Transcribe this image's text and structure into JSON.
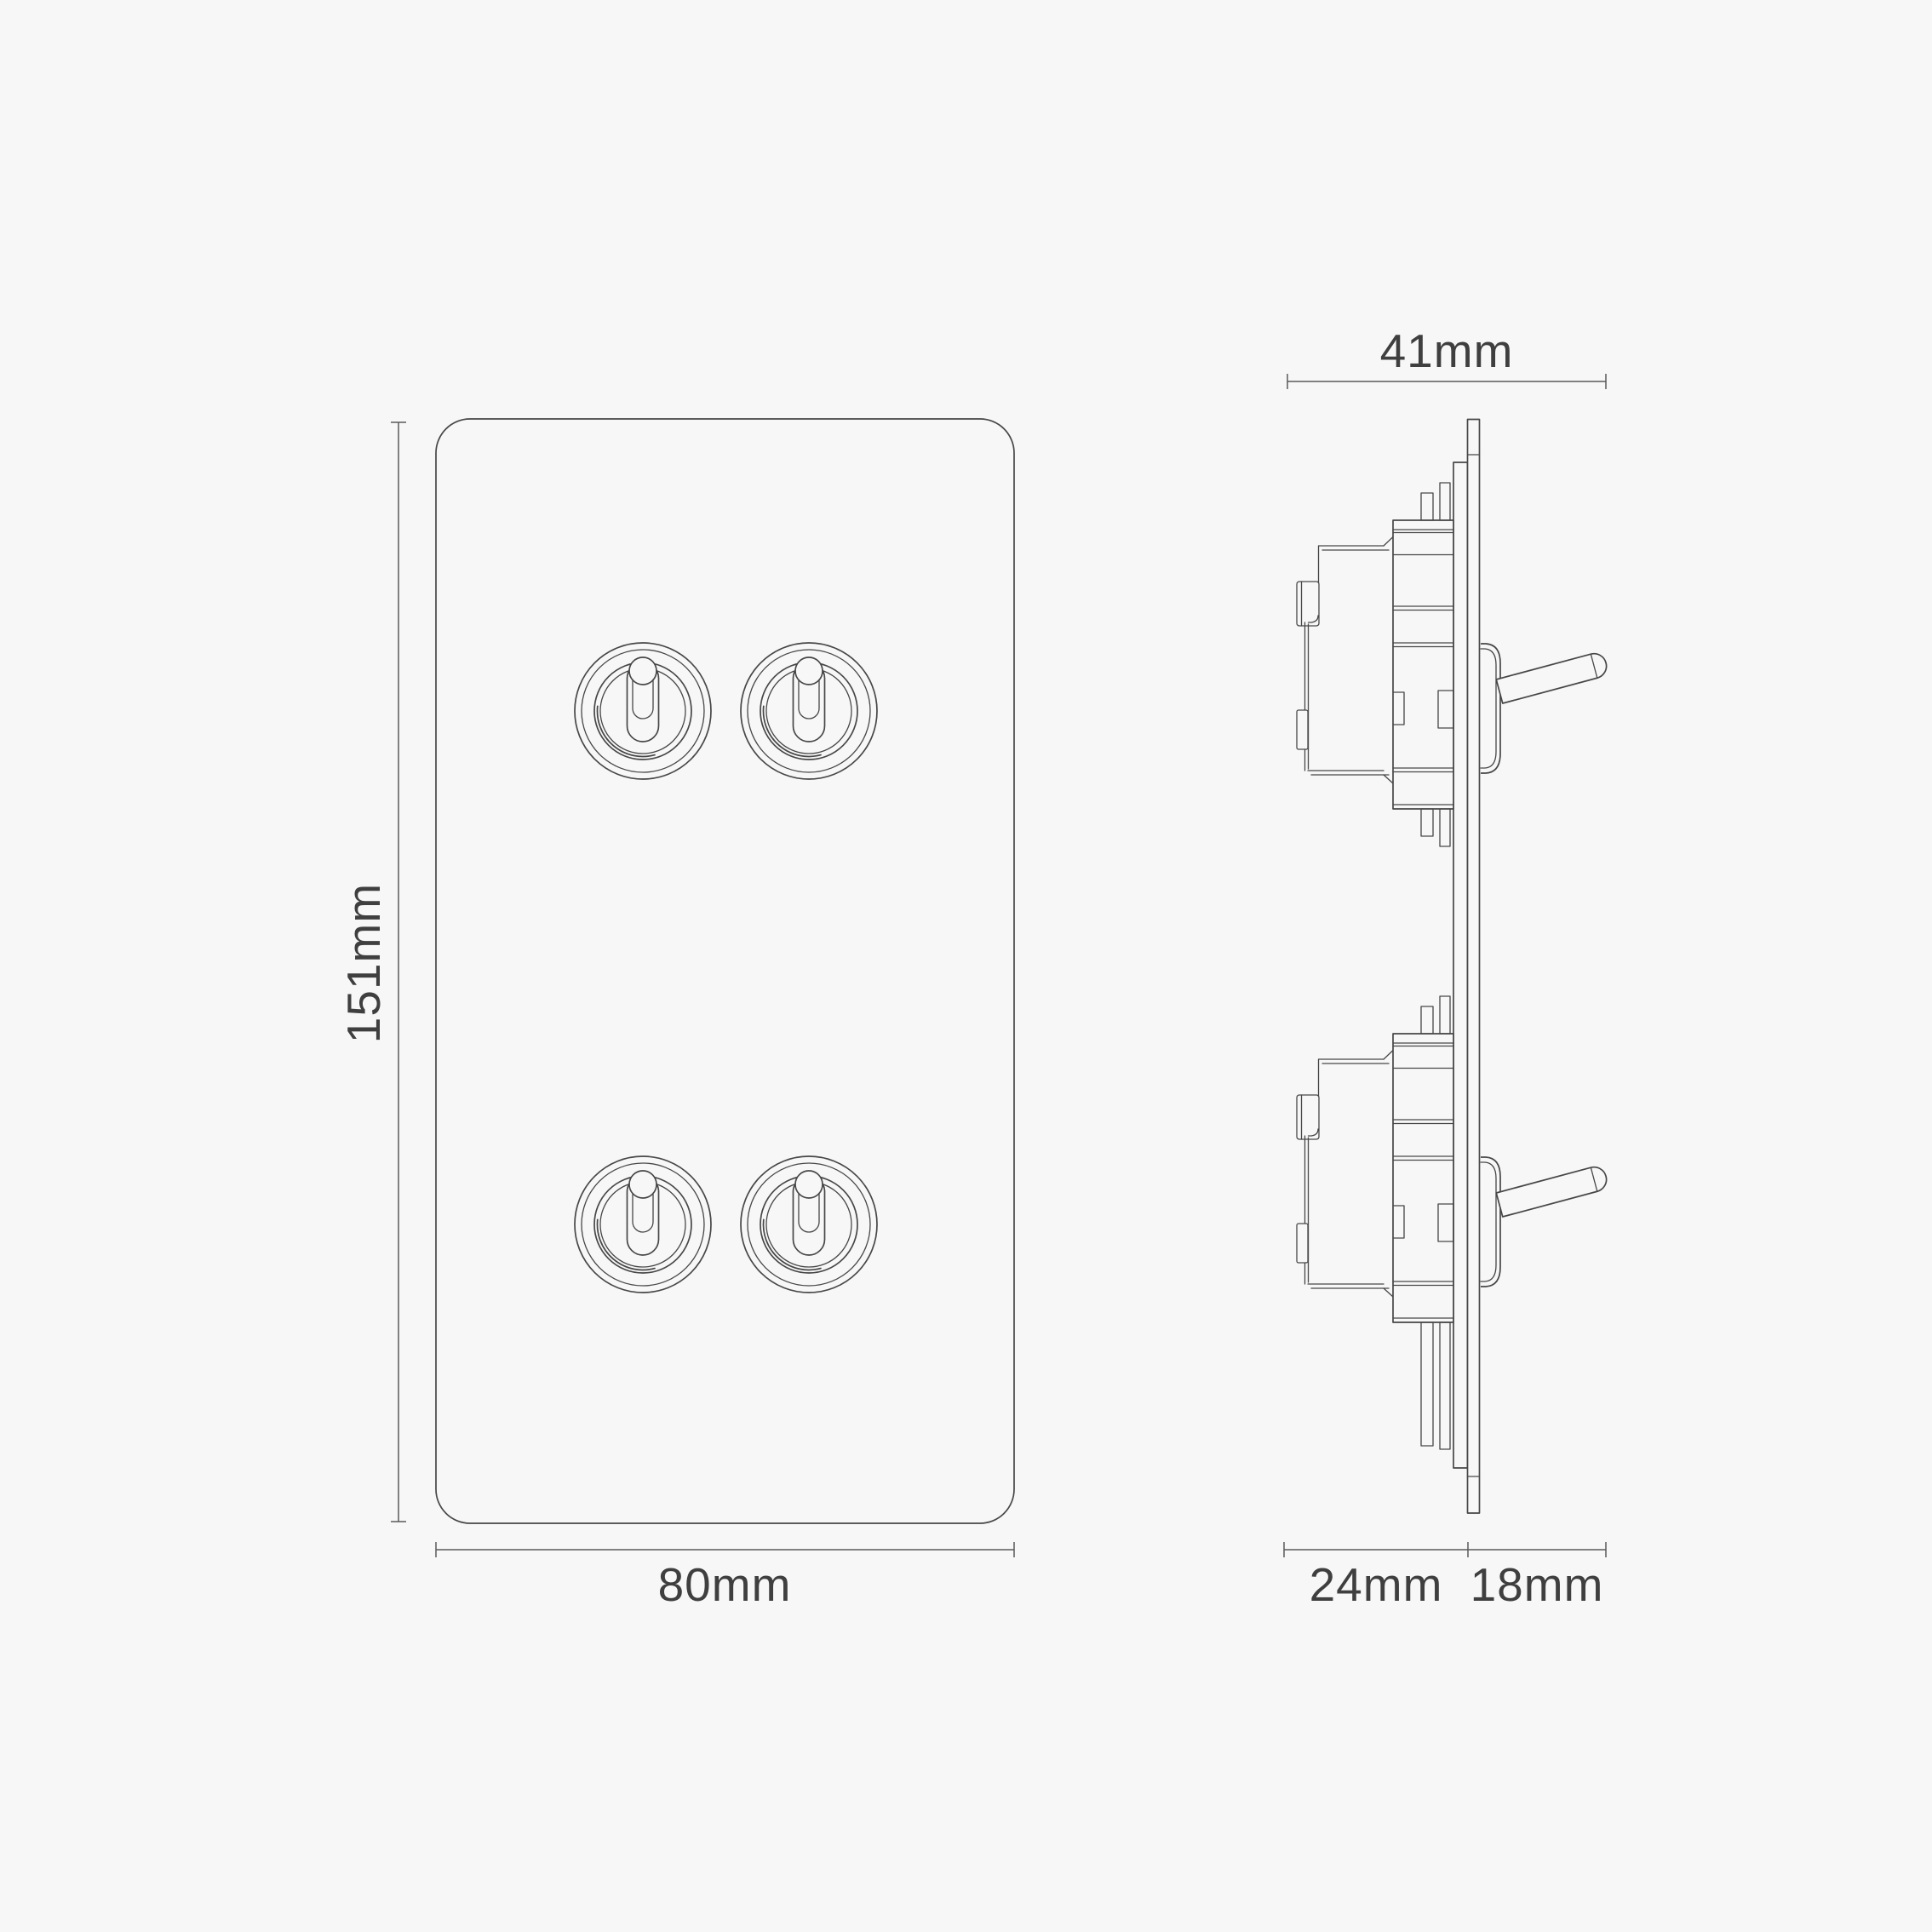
{
  "page": {
    "background_color": "#f7f7f7",
    "line_color": "#474747",
    "dimension_line_color": "#5a5a5a",
    "text_color": "#3f3f3f"
  },
  "drawing": {
    "type": "technical dimension drawing",
    "subject": "double vertical toggle switch plate, 4 toggle levers",
    "views": {
      "front_view": {
        "toggle_count": 4,
        "rows": 2,
        "columns": 2
      },
      "side_view": {
        "toggle_count": 2,
        "modules": 2
      }
    }
  },
  "dimensions": {
    "plate_height": "151mm",
    "plate_width": "80mm",
    "overall_depth": "41mm",
    "box_depth": "24mm",
    "front_projection": "18mm"
  }
}
